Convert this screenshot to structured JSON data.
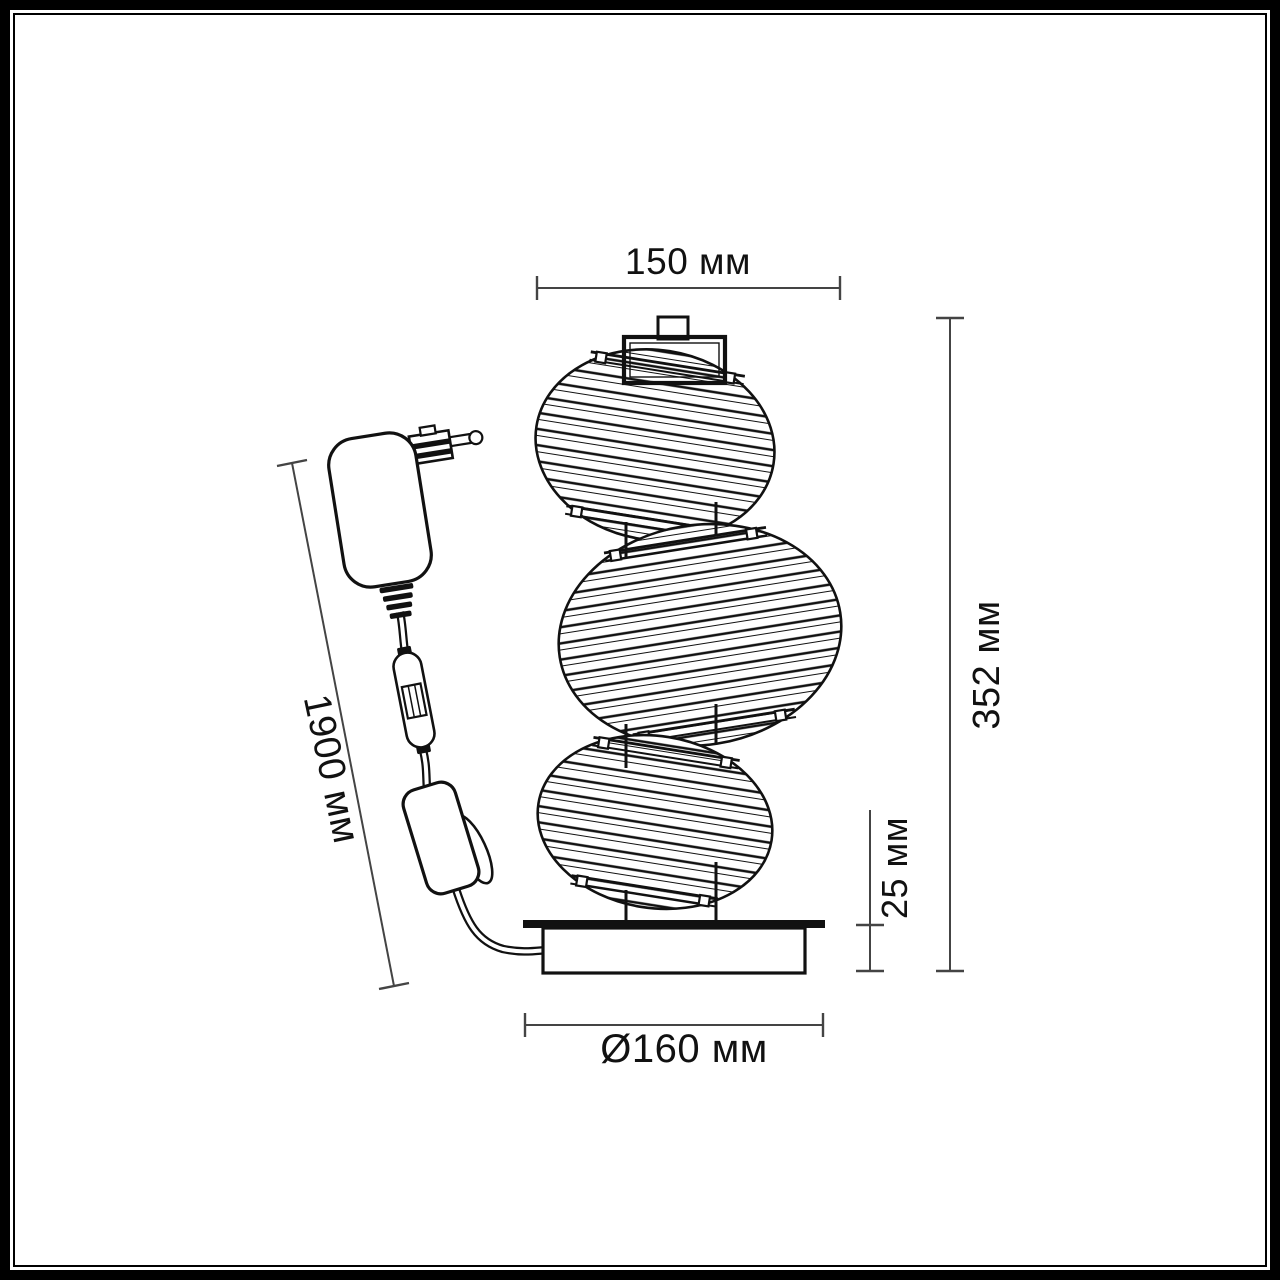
{
  "colors": {
    "background": "#ffffff",
    "frame": "#000000",
    "drawing_line": "#111111",
    "dimension_line": "#444444",
    "text": "#111111"
  },
  "dimensions": {
    "top_width": {
      "label": "150 мм",
      "value": 150,
      "unit": "мм"
    },
    "total_height": {
      "label": "352 мм",
      "value": 352,
      "unit": "мм"
    },
    "base_height": {
      "label": "25 мм",
      "value": 25,
      "unit": "мм"
    },
    "base_diameter": {
      "label": "Ø160 мм",
      "value": 160,
      "unit": "мм"
    },
    "cable_length": {
      "label": "1900 мм",
      "value": 1900,
      "unit": "мм"
    }
  }
}
